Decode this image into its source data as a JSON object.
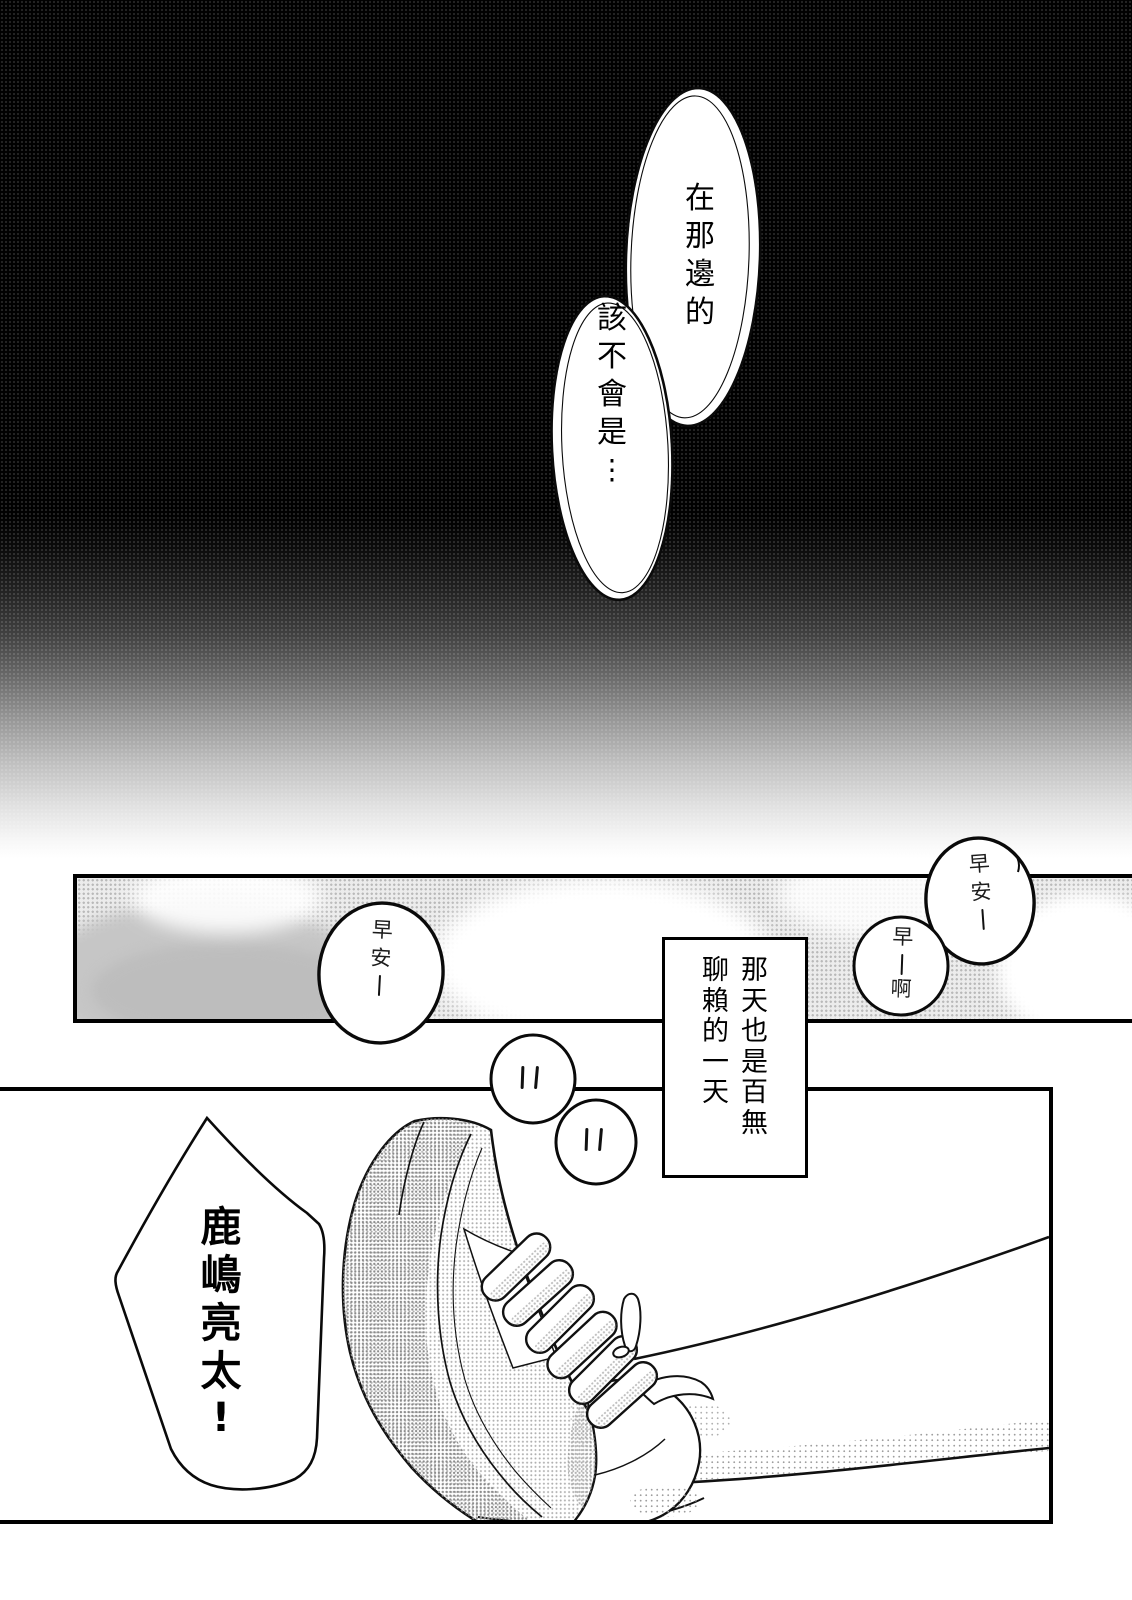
{
  "page": {
    "kind": "manga-page",
    "colors": {
      "ink": "#000000",
      "paper": "#ffffff",
      "sky_tone": "#ececec",
      "cloud_shadow": "#c6c6c6"
    }
  },
  "speech": {
    "offscreen_top": {
      "bubble1": "在那邊的",
      "bubble2": "該不會是⋮"
    },
    "narration": {
      "col_right": "那天也是百無",
      "col_left": "聊賴的一天"
    },
    "greetings": {
      "left": "早安—",
      "right": "早安—",
      "reply": "早—啊"
    },
    "shout": "鹿嶋亮太!"
  }
}
